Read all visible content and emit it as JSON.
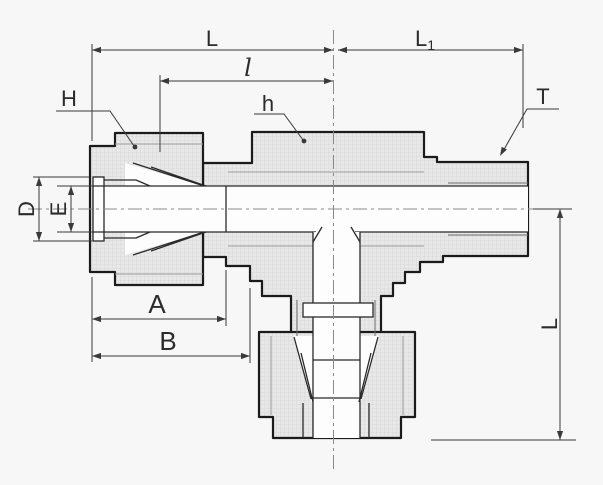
{
  "diagram": {
    "type": "technical-drawing",
    "component": "male-branch-tee-tube-fitting-cross-section",
    "colors": {
      "background": "#f7f7f7",
      "part_fill": "#e8e8e8",
      "pattern_line": "#d9d9d9",
      "outline": "#1b1b1b",
      "dimension_lines": "#3a3a3a",
      "label_text": "#2b2b2b",
      "centerline": "#8a8a8a"
    },
    "dimensions": {
      "top_left_length": "L",
      "top_right_length": "L",
      "top_right_length_subscript": "1",
      "inner_length": "l",
      "nut_hex_size": "H",
      "body_hex_size": "h",
      "thread_size": "T",
      "tube_support_od": "D",
      "bore_diameter": "E",
      "nut_length": "A",
      "body_end_length": "B",
      "branch_length": "L"
    }
  }
}
